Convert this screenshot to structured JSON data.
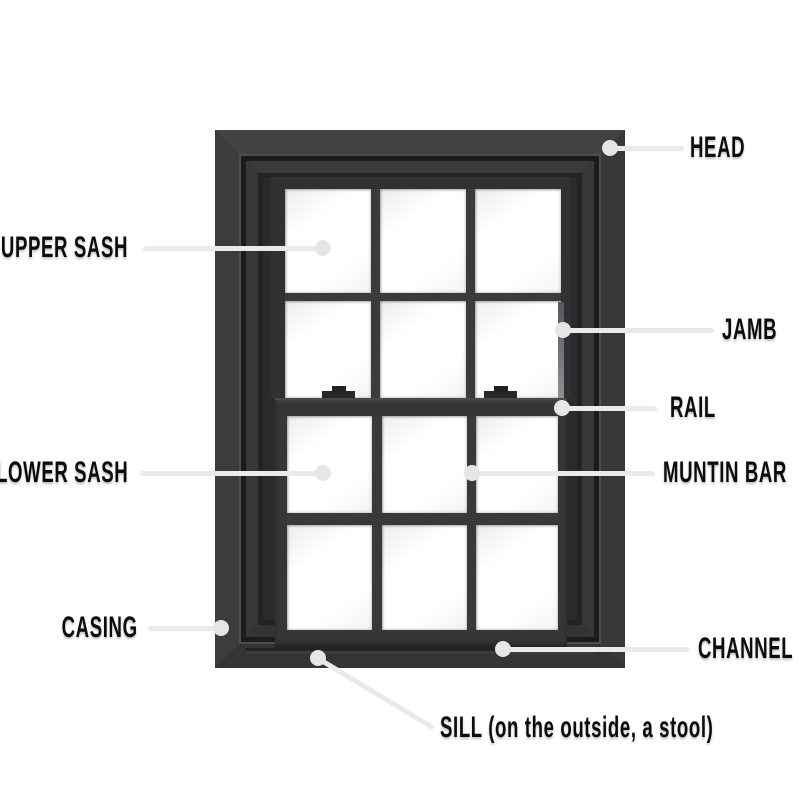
{
  "labels": {
    "head": "HEAD",
    "upper_sash": "UPPER SASH",
    "jamb": "JAMB",
    "rail": "RAIL",
    "lower_sash": "LOWER SASH",
    "muntin_bar": "MUNTIN BAR",
    "casing": "CASING",
    "channel": "CHANNEL",
    "sill": "SILL (on the outside, a stool)"
  },
  "colors": {
    "background": "#ffffff",
    "frame_mid": "#3b3b3e",
    "frame_dark": "#232326",
    "groove": "#1b1b1d",
    "glass": "#ffffff",
    "callout_line": "#eaeaea",
    "callout_dot": "#e6e6e6",
    "label_text": "#0c0c0c"
  }
}
